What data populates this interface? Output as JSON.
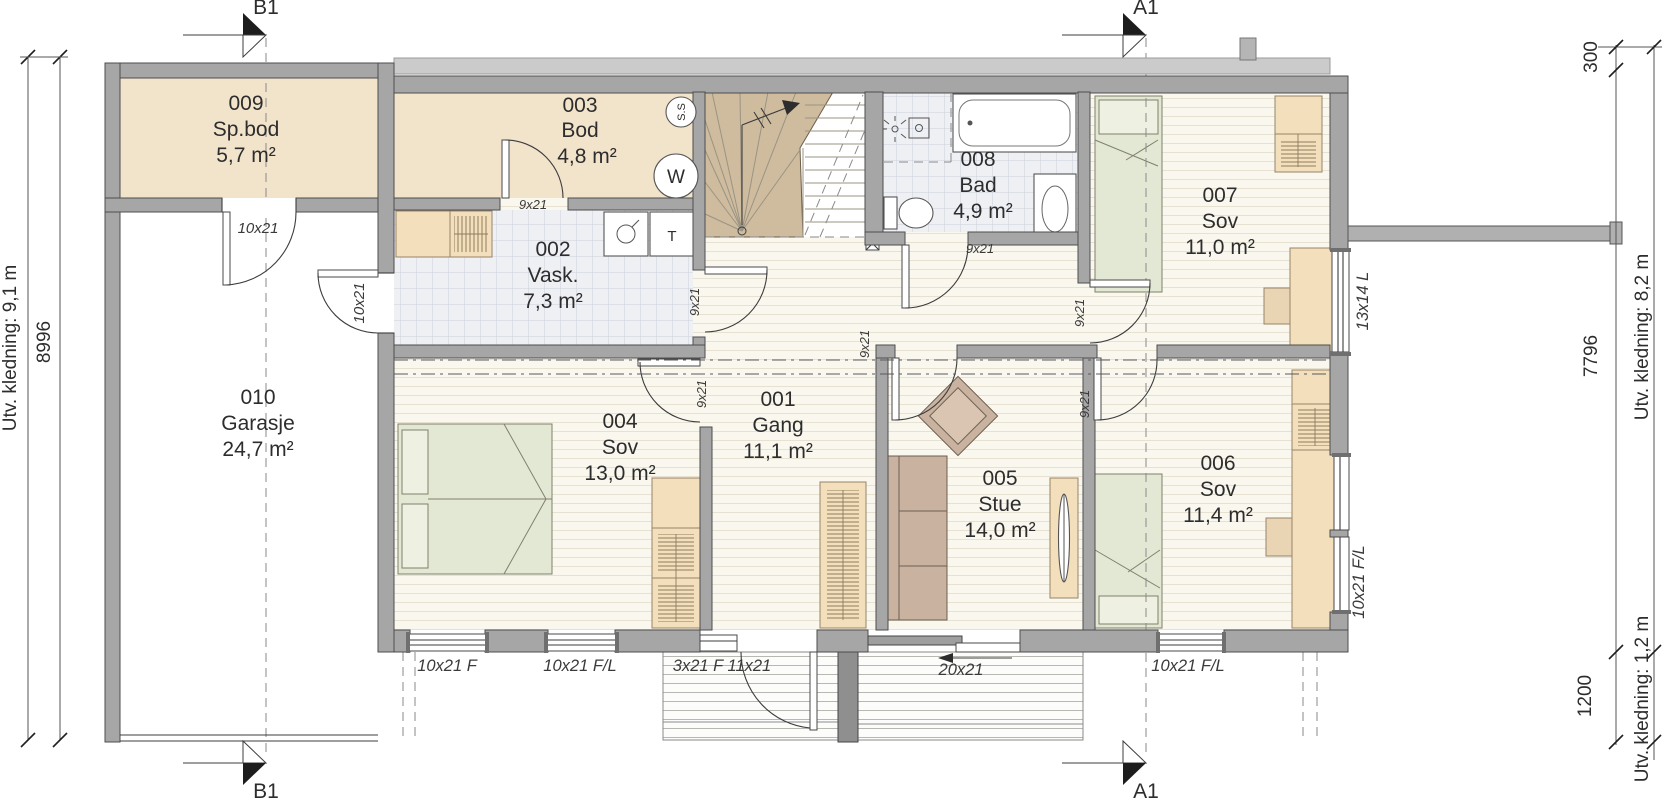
{
  "rooms": [
    {
      "number": "001",
      "name": "Gang",
      "area": "11,1 m²"
    },
    {
      "number": "002",
      "name": "Vask.",
      "area": "7,3 m²"
    },
    {
      "number": "003",
      "name": "Bod",
      "area": "4,8 m²"
    },
    {
      "number": "004",
      "name": "Sov",
      "area": "13,0 m²"
    },
    {
      "number": "005",
      "name": "Stue",
      "area": "14,0 m²"
    },
    {
      "number": "006",
      "name": "Sov",
      "area": "11,4 m²"
    },
    {
      "number": "007",
      "name": "Sov",
      "area": "11,0 m²"
    },
    {
      "number": "008",
      "name": "Bad",
      "area": "4,9 m²"
    },
    {
      "number": "009",
      "name": "Sp.bod",
      "area": "5,7 m²"
    },
    {
      "number": "010",
      "name": "Garasje",
      "area": "24,7 m²"
    }
  ],
  "openings": {
    "door_spbod": "10x21",
    "door_garasje_vask": "10x21",
    "door_bod": "9x21",
    "door_vask": "9x21",
    "door_bad": "9x21",
    "door_sov004": "9x21",
    "door_stue": "9x21",
    "door_sov006": "9x21",
    "door_sov007": "9x21",
    "win_south_1": "10x21 F",
    "win_south_2": "10x21 F/L",
    "entrance": "3x21 F 11x21",
    "sliding_door": "20x21",
    "win_south_3": "10x21 F/L",
    "win_east_top": "13x14 L",
    "win_east_bottom": "10x21 F/L"
  },
  "appliances": {
    "dryer": "T",
    "water_heater": "W",
    "ss": "S.S"
  },
  "sections": {
    "a1": "A1",
    "b1": "B1"
  },
  "dimensions": {
    "left_cladding": "Utv. kledning: 9,1 m",
    "left_width": "8996",
    "right_offset": "300",
    "right_height": "7796",
    "right_cladding_upper": "Utv. kledning: 8,2 m",
    "right_lower": "1200",
    "right_cladding_lower": "Utv. kledning: 1,2 m"
  }
}
